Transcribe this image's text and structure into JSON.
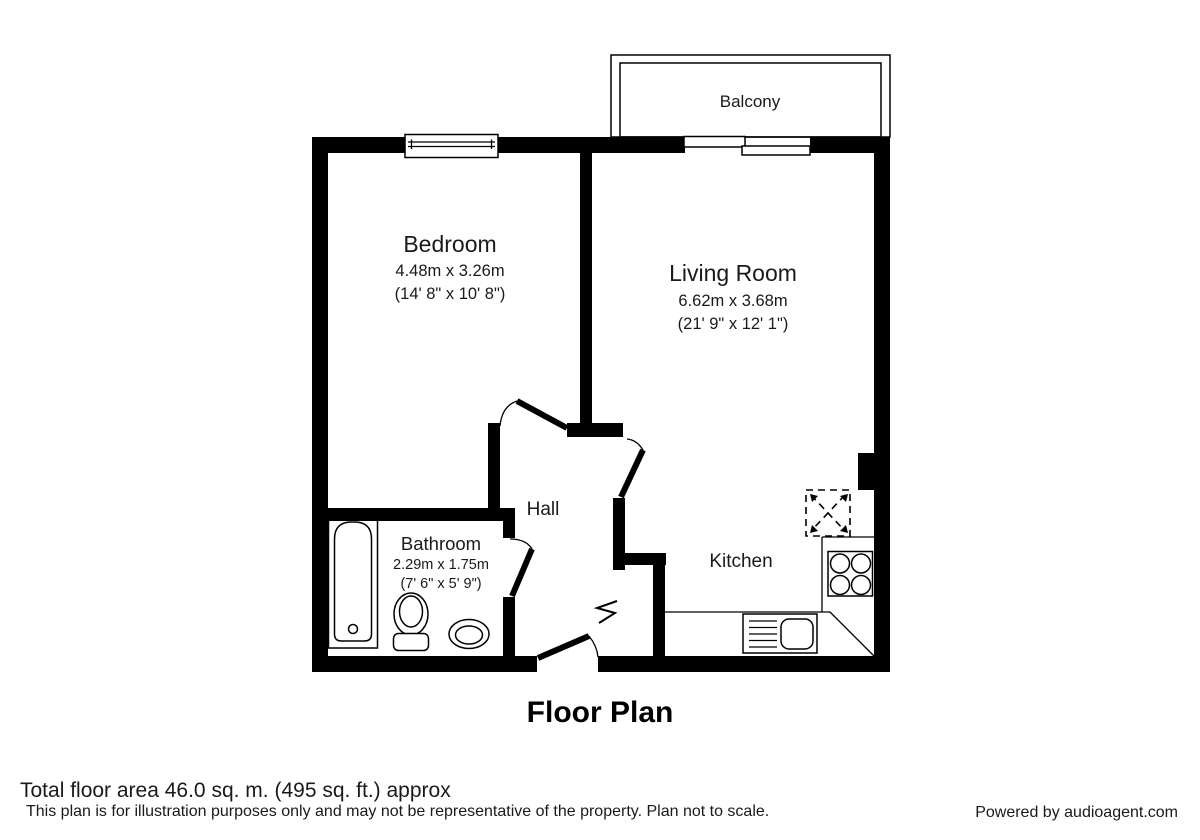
{
  "title": "Floor Plan",
  "rooms": {
    "balcony": {
      "name": "Balcony"
    },
    "bedroom": {
      "name": "Bedroom",
      "dims_metric": "4.48m x 3.26m",
      "dims_imperial": "(14' 8\" x 10' 8\")"
    },
    "living_room": {
      "name": "Living Room",
      "dims_metric": "6.62m x 3.68m",
      "dims_imperial": "(21' 9\" x 12' 1\")"
    },
    "hall": {
      "name": "Hall"
    },
    "bathroom": {
      "name": "Bathroom",
      "dims_metric": "2.29m x 1.75m",
      "dims_imperial": "(7' 6\" x 5' 9\")"
    },
    "kitchen": {
      "name": "Kitchen"
    }
  },
  "footer": {
    "total_area": "Total floor area 46.0 sq. m. (495 sq. ft.) approx",
    "disclaimer": "This plan is for illustration purposes only and may not be representative of the property. Plan not to scale.",
    "credit": "Powered by audioagent.com"
  },
  "colors": {
    "wall": "#000000",
    "background": "#ffffff",
    "text": "#1a1a1a"
  }
}
